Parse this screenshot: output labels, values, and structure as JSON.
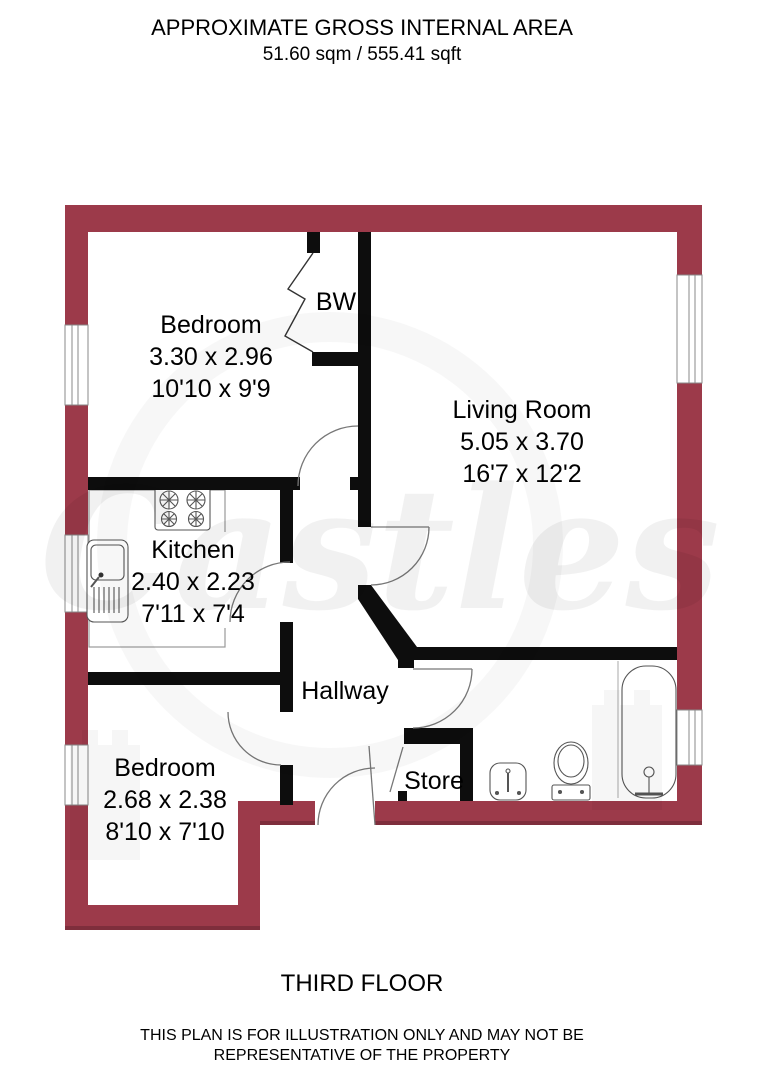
{
  "header": {
    "line1": "APPROXIMATE GROSS INTERNAL AREA",
    "line2": "51.60 sqm / 555.41 sqft"
  },
  "rooms": {
    "bedroom_top": {
      "name": "Bedroom",
      "metric": "3.30 x 2.96",
      "imperial": "10'10 x 9'9"
    },
    "built_in_wardrobe": {
      "abbr": "BW"
    },
    "living_room": {
      "name": "Living Room",
      "metric": "5.05 x 3.70",
      "imperial": "16'7 x 12'2"
    },
    "kitchen": {
      "name": "Kitchen",
      "metric": "2.40 x 2.23",
      "imperial": "7'11 x 7'4"
    },
    "hallway": {
      "name": "Hallway"
    },
    "bedroom_bottom": {
      "name": "Bedroom",
      "metric": "2.68 x 2.38",
      "imperial": "8'10 x 7'10"
    },
    "store": {
      "name": "Store"
    }
  },
  "footer": {
    "floor_label": "THIRD FLOOR",
    "disclaimer_line1": "THIS PLAN IS FOR ILLUSTRATION ONLY AND MAY NOT BE",
    "disclaimer_line2": "REPRESENTATIVE OF THE PROPERTY"
  },
  "watermark": {
    "brand": "Castles"
  },
  "colors": {
    "outer_wall": "#9c3a4a",
    "outer_wall_shadow": "#7e2e3c",
    "interior_wall": "#0d0d0d"
  }
}
